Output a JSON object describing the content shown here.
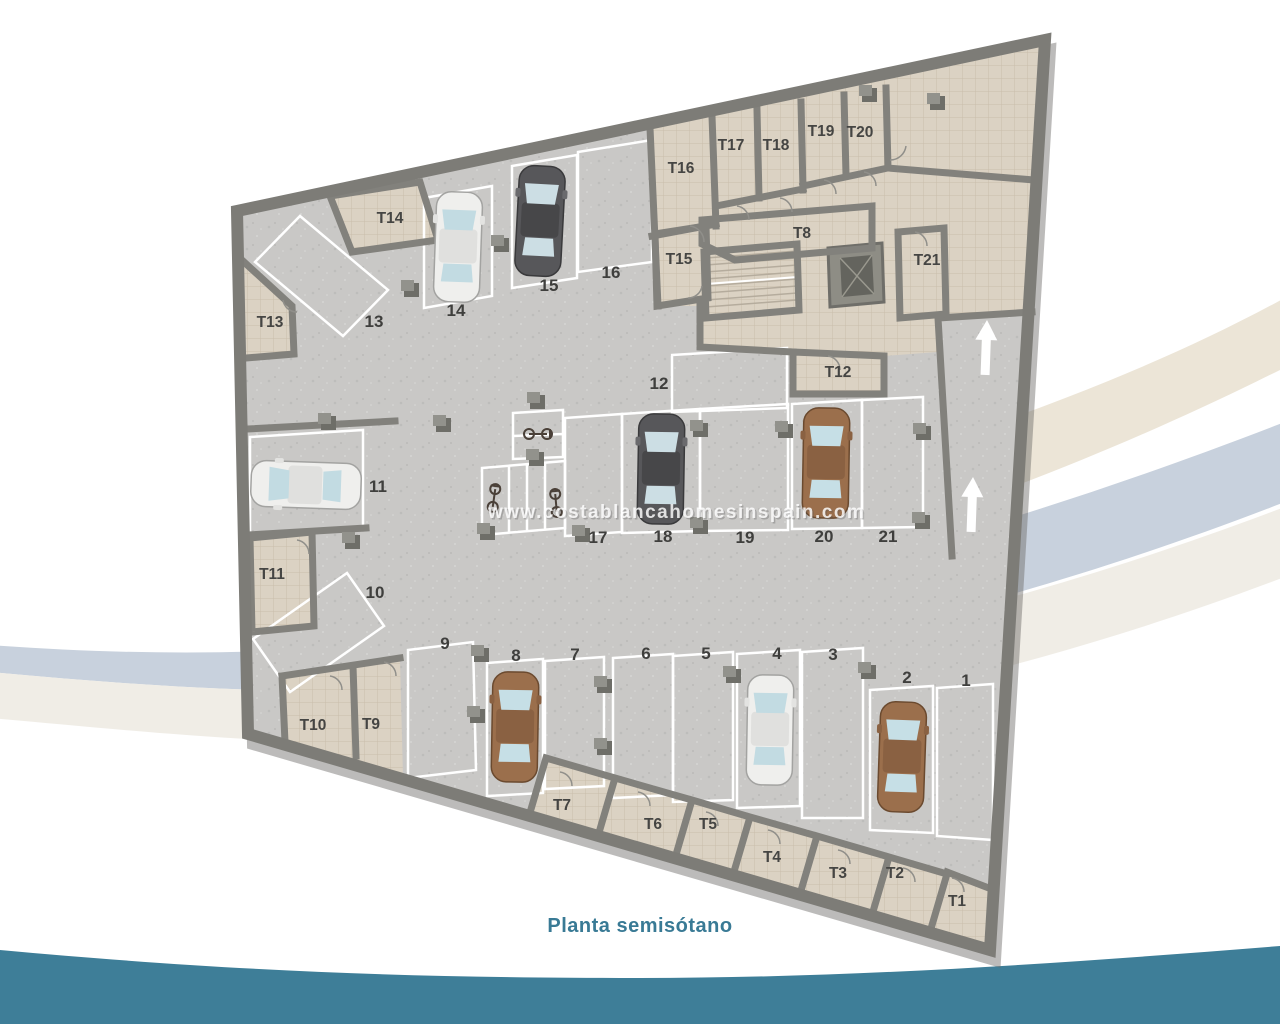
{
  "caption": {
    "text": "Planta semisótano"
  },
  "watermark": {
    "text": "www.costablancahomesinspain.com"
  },
  "plan": {
    "description": "Semi-basement parking floor plan with 21 parking spots, 21 storage rooms, bike stalls, stairs, elevator and entrance ramp",
    "parking_labels": [
      "1",
      "2",
      "3",
      "4",
      "5",
      "6",
      "7",
      "8",
      "9",
      "10",
      "11",
      "12",
      "13",
      "14",
      "15",
      "16",
      "17",
      "18",
      "19",
      "20",
      "21"
    ],
    "storage_labels": [
      "T1",
      "T2",
      "T3",
      "T4",
      "T5",
      "T6",
      "T7",
      "T8",
      "T9",
      "T10",
      "T11",
      "T12",
      "T13",
      "T14",
      "T15",
      "T16",
      "T17",
      "T18",
      "T19",
      "T20",
      "T21"
    ],
    "cars": [
      {
        "spot": "2",
        "color": "brown"
      },
      {
        "spot": "4",
        "color": "white"
      },
      {
        "spot": "8",
        "color": "brown"
      },
      {
        "spot": "11",
        "color": "white"
      },
      {
        "spot": "14",
        "color": "white"
      },
      {
        "spot": "15",
        "color": "dark-gray"
      },
      {
        "spot": "18",
        "color": "dark-gray"
      },
      {
        "spot": "20",
        "color": "brown"
      }
    ],
    "bike_spaces": 3,
    "ramp_arrow_count": 2,
    "colors": {
      "floor": "#c9c8c6",
      "storage_floor": "#dbd2c3",
      "wall": "#7d7c77",
      "marking": "#ffffff",
      "label": "#3f3f3d",
      "caption": "#397a95",
      "wave": "#3e7e98"
    }
  }
}
